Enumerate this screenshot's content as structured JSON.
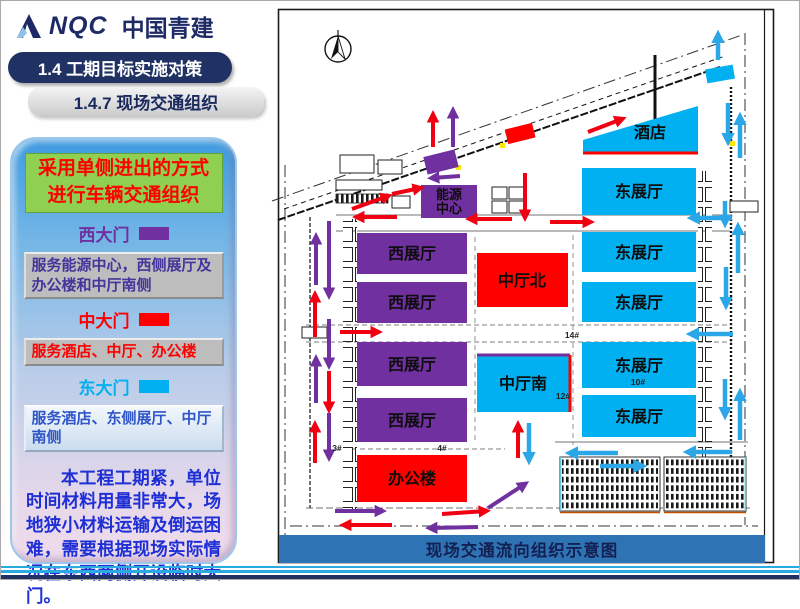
{
  "header": {
    "brand": "NQC",
    "brand_cn": "中国青建",
    "title": "1.4 工期目标实施对策",
    "subtitle": "1.4.7 现场交通组织"
  },
  "sidebar": {
    "highlight_line1": "采用单侧进出的方式",
    "highlight_line2": "进行车辆交通组织",
    "gates": [
      {
        "name": "西大门",
        "color": "#7030A0",
        "desc": "服务能源中心，西侧展厅及办公楼和中厅南侧"
      },
      {
        "name": "中大门",
        "color": "#FF0000",
        "desc": "服务酒店、中厅、办公楼"
      },
      {
        "name": "东大门",
        "color": "#00B0F0",
        "desc": "服务酒店、东侧展厅、中厅南侧"
      }
    ],
    "note": "本工程工期紧，单位时间材料用量非常大，场地狭小材料运输及倒运困难，需要根据现场实际情况在东西两侧开设临时大门。"
  },
  "map": {
    "caption": "现场交通流向组织示意图",
    "buildings": {
      "hotel": "酒店",
      "east_hall": "东展厅",
      "west_hall": "西展厅",
      "center_hall_north": "中厅北",
      "center_hall_south": "中厅南",
      "office": "办公楼",
      "energy_center": [
        "能源",
        "中心"
      ]
    },
    "plot_labels": {
      "p3": "3#",
      "p4": "4#",
      "p10": "10#",
      "p12": "12#",
      "p14": "14#"
    },
    "legend_colors": {
      "west_route": "#7030A0",
      "mid_route": "#FF0000",
      "east_route": "#00B0F0",
      "arrow_blue": "#2BA7E8"
    }
  }
}
